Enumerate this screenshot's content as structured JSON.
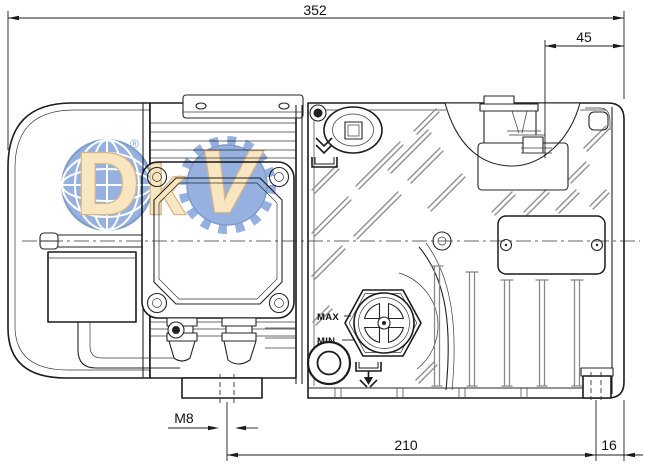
{
  "dimensions": {
    "overall_length_mm": "352",
    "inlet_to_edge_mm": "45",
    "mounting_thread": "M8",
    "foot_hole_spacing_mm": "210",
    "foot_to_edge_mm": "16"
  },
  "oil_level_labels": {
    "max": "MAX",
    "min": "MIN"
  },
  "watermark": {
    "brand": "DKV",
    "letter_d": "D",
    "letter_k": "k",
    "letter_v": "V",
    "registered": "®",
    "globe_color": "#7b9ed8",
    "letter_color": "#f6e0b2",
    "letter_outline": "#cfa36a"
  },
  "colors": {
    "line": "#1c1c1c",
    "background": "#ffffff"
  }
}
